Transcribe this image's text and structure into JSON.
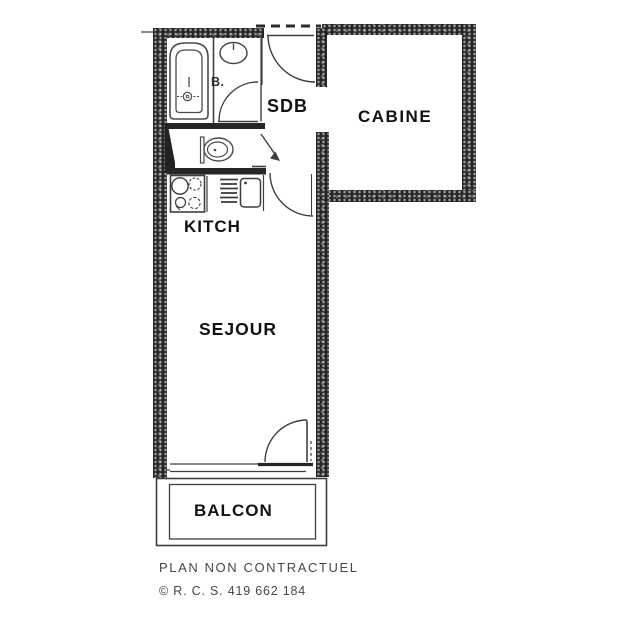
{
  "plan": {
    "rooms": [
      {
        "name": "bathroom",
        "label": "SDB"
      },
      {
        "name": "cabin",
        "label": "CABINE"
      },
      {
        "name": "kitchen",
        "label": "KITCH"
      },
      {
        "name": "living-room",
        "label": "SEJOUR"
      },
      {
        "name": "balcony",
        "label": "BALCON"
      }
    ],
    "bath_annotation": "B.",
    "fixtures": [
      "bathtub-icon",
      "washbasin-icon",
      "toilet-icon",
      "stove-icon",
      "drainer-rack-icon",
      "kitchen-sink-icon"
    ],
    "colors": {
      "wall": "#262626",
      "linework": "#3f3f3f",
      "label_text": "#111111",
      "footer_text": "#474747",
      "background": "#ffffff"
    }
  },
  "footer": {
    "disclaimer": "PLAN NON CONTRACTUEL",
    "registration": "© R. C. S. 419 662 184"
  }
}
